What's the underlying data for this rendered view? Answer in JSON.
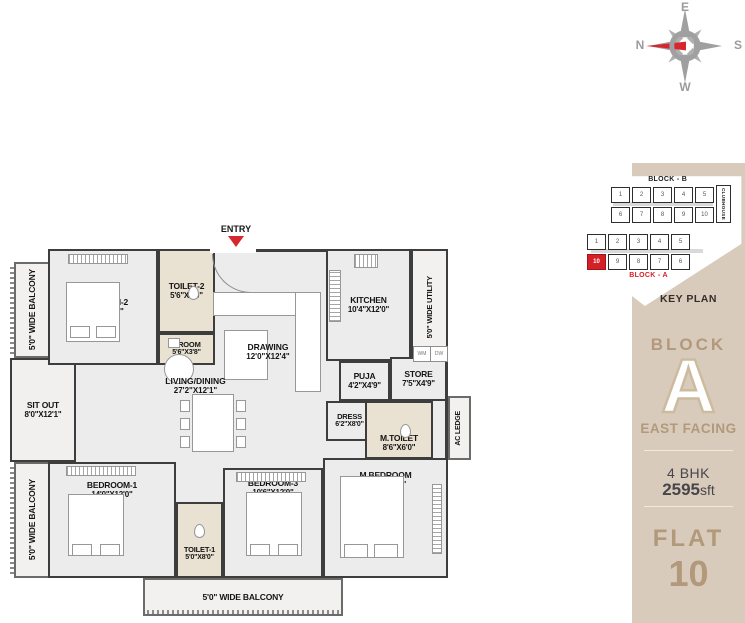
{
  "compass": {
    "n": "N",
    "e": "E",
    "s": "S",
    "w": "W",
    "needle_color": "#d7272e",
    "rose_color": "#a0a0a0"
  },
  "key_plan": {
    "title": "KEY PLAN",
    "block_b_label": "BLOCK - B",
    "block_a_label": "BLOCK - A",
    "clubhouse_label": "CLUBHOUSE",
    "block_b_row1": [
      "1",
      "2",
      "3",
      "4",
      "5"
    ],
    "block_b_row2": [
      "6",
      "7",
      "8",
      "9",
      "10"
    ],
    "block_a_row1": [
      "1",
      "2",
      "3",
      "4",
      "5"
    ],
    "block_a_row2": [
      "10",
      "9",
      "8",
      "7",
      "6"
    ],
    "highlight_unit": "10",
    "highlight_color": "#d42027"
  },
  "sidebar": {
    "block_label": "BLOCK",
    "block_letter": "A",
    "facing": "EAST FACING",
    "bhk": "4 BHK",
    "area_value": "2595",
    "area_unit": "sft",
    "flat_label": "FLAT",
    "flat_number": "10",
    "bg_color": "#d9cbbc",
    "accent_color": "#b2997b"
  },
  "plan": {
    "entry": "ENTRY",
    "rooms": {
      "bedroom2": {
        "name": "BEDROOM-2",
        "dims": "12'0\"X12'0\""
      },
      "toilet2": {
        "name": "TOILET-2",
        "dims": "5'6\"X8'0\""
      },
      "proom": {
        "name": "P.ROOM",
        "dims": "5'6\"X3'8\""
      },
      "drawing": {
        "name": "DRAWING",
        "dims": "12'0\"X12'4\""
      },
      "kitchen": {
        "name": "KITCHEN",
        "dims": "10'4\"X12'0\""
      },
      "utility": {
        "name": "5'0\" WIDE UTILITY"
      },
      "balcony_top_left": {
        "name": "5'0\" WIDE BALCONY"
      },
      "sitout": {
        "name": "SIT OUT",
        "dims": "8'0\"X12'1\""
      },
      "balcony_bottom_left": {
        "name": "5'0\" WIDE BALCONY"
      },
      "living": {
        "name": "LIVING/DINING",
        "dims": "27'2\"X12'1\""
      },
      "puja": {
        "name": "PUJA",
        "dims": "4'2\"X4'9\""
      },
      "store": {
        "name": "STORE",
        "dims": "7'5\"X4'9\""
      },
      "dress": {
        "name": "DRESS",
        "dims": "6'2\"X8'0\""
      },
      "mtoilet": {
        "name": "M.TOILET",
        "dims": "8'6\"X6'0\""
      },
      "acledge": {
        "name": "AC LEDGE"
      },
      "bedroom1": {
        "name": "BEDROOM-1",
        "dims": "14'0\"X12'0\""
      },
      "toilet1": {
        "name": "TOILET-1",
        "dims": "5'0\"X8'0\""
      },
      "bedroom3": {
        "name": "BEDROOM-3",
        "dims": "10'6\"X12'0\""
      },
      "mbedroom": {
        "name": "M.BEDROOM",
        "dims": "15'0\"X13'0\""
      },
      "balcony_bottom": {
        "name": "5'0\" WIDE BALCONY"
      },
      "wm": "WM",
      "dw": "DW"
    }
  }
}
